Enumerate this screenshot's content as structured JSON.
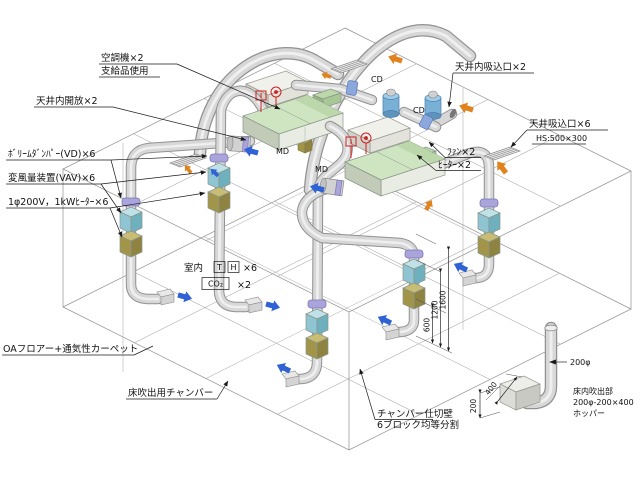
{
  "diagram": {
    "type": "isometric-hvac-underfloor-air-distribution",
    "ann": {
      "ahu1": "空調機×2",
      "ahu2": "支給品使用",
      "ceil_open": "天井内開放×2",
      "ceil_plenum_in": "天井内吸込口×2",
      "ceil_in1": "天井吸込口×6",
      "ceil_in2": "HS:500×300",
      "vd": "ﾎﾞﾘｰﾑﾀﾞﾝﾊﾟｰ(VD)×6",
      "vav": "変風量装置(VAV)×6",
      "ehtr": "1φ200V，1kWﾋｰﾀｰ×6",
      "room": "室内",
      "t": "T",
      "h": "H",
      "th_n": "×6",
      "co2": "CO₂",
      "co2_n": "×2",
      "oa": "OAフロアー+通気性カーペット",
      "chamber": "床吹出用チャンバー",
      "part1": "チャンバー仕切壁",
      "part2": "6ブロック均等分割",
      "out1": "床内吹出部",
      "out2": "200φ-200×400",
      "out3": "ホッパー",
      "dia": "200φ",
      "fan": "ﾌｧﾝ×2",
      "htr": "ﾋｰﾀｰ×2",
      "cd": "CD",
      "md": "MD"
    },
    "dims": {
      "d600": "600",
      "d1200": "1200",
      "d1600": "1600",
      "d400": "400",
      "d200": "200"
    },
    "colors": {
      "duct": "#d7d7d7",
      "duct_edge": "#919191",
      "ahu_top": "#cfe5c1",
      "ahu_front": "#e9ece3",
      "ahu_side": "#c2cbb8",
      "ahu_dark": "#bcd8ab",
      "vav_box": "#a8d6e0",
      "heater_box": "#b5a95f",
      "damper_ring": "#a9a4da",
      "fan_blue": "#79b0d6",
      "coupling_blue": "#8aa8dc",
      "arrow_blue": "#2f62d4",
      "arrow_orange": "#e0831f",
      "flag_red": "#cc2020",
      "line": "#1a1a1a",
      "grid": "#a9a9a9"
    }
  }
}
